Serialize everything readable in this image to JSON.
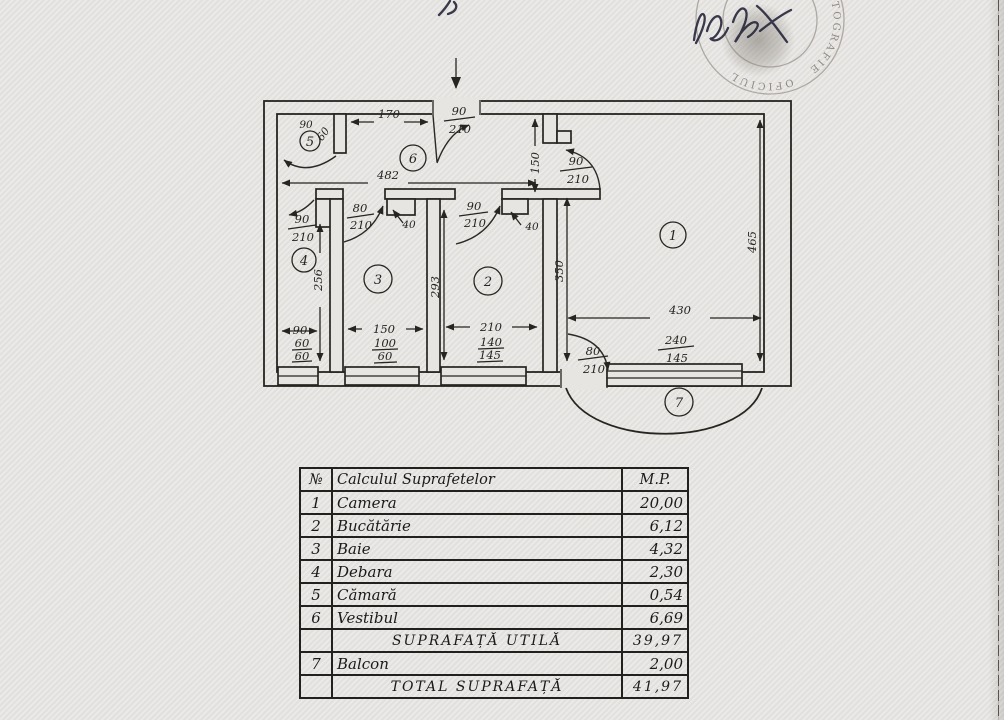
{
  "page": {
    "background": "#e7e5e2",
    "ink": "#26251f",
    "stamp_color": "#8f8b83"
  },
  "plan": {
    "rooms": {
      "r1": "1",
      "r2": "2",
      "r3": "3",
      "r4": "4",
      "r5": "5",
      "r6": "6",
      "r7": "7"
    },
    "dims": {
      "hall_width": "482",
      "hall_top": "170",
      "niche_depth": "150",
      "r4_height": "256",
      "r2_height": "293",
      "r1_left_height": "350",
      "r1_right_height": "465",
      "r1_width": "430",
      "pantry_w": "90",
      "pantry_d": "60",
      "r4_w": "90",
      "r4_win_w": "60",
      "r4_win_h": "60",
      "r3_w": "150",
      "r3_win_w": "100",
      "r3_win_h": "60",
      "r2_w": "210",
      "r2_win_w": "140",
      "r2_win_h": "145",
      "r1_win_w": "240",
      "r1_win_h": "145",
      "wall40_a": "40",
      "wall40_b": "40"
    },
    "doors": {
      "entrance": {
        "w": "90",
        "h": "210"
      },
      "room1": {
        "w": "90",
        "h": "210"
      },
      "room4": {
        "w": "90",
        "h": "210"
      },
      "room3": {
        "w": "80",
        "h": "210"
      },
      "room2": {
        "w": "90",
        "h": "210"
      },
      "balcony": {
        "w": "80",
        "h": "210"
      }
    }
  },
  "stamp": {
    "arc_text_right": "CARTOGRAFIE",
    "arc_text_bottom": "OFICIUL"
  },
  "table": {
    "header": {
      "num": "№",
      "name": "Calculul Suprafetelor",
      "unit": "M.P."
    },
    "rows": [
      {
        "num": "1",
        "name": "Camera",
        "value": "20,00"
      },
      {
        "num": "2",
        "name": "Bucătărie",
        "value": "6,12"
      },
      {
        "num": "3",
        "name": "Baie",
        "value": "4,32"
      },
      {
        "num": "4",
        "name": "Debara",
        "value": "2,30"
      },
      {
        "num": "5",
        "name": "Cămară",
        "value": "0,54"
      },
      {
        "num": "6",
        "name": "Vestibul",
        "value": "6,69"
      },
      {
        "num": "",
        "name": "SUPRAFAȚĂ UTILĂ",
        "value": "39,97"
      },
      {
        "num": "7",
        "name": "Balcon",
        "value": "2,00"
      },
      {
        "num": "",
        "name": "TOTAL SUPRAFAȚĂ",
        "value": "41,97"
      }
    ]
  }
}
